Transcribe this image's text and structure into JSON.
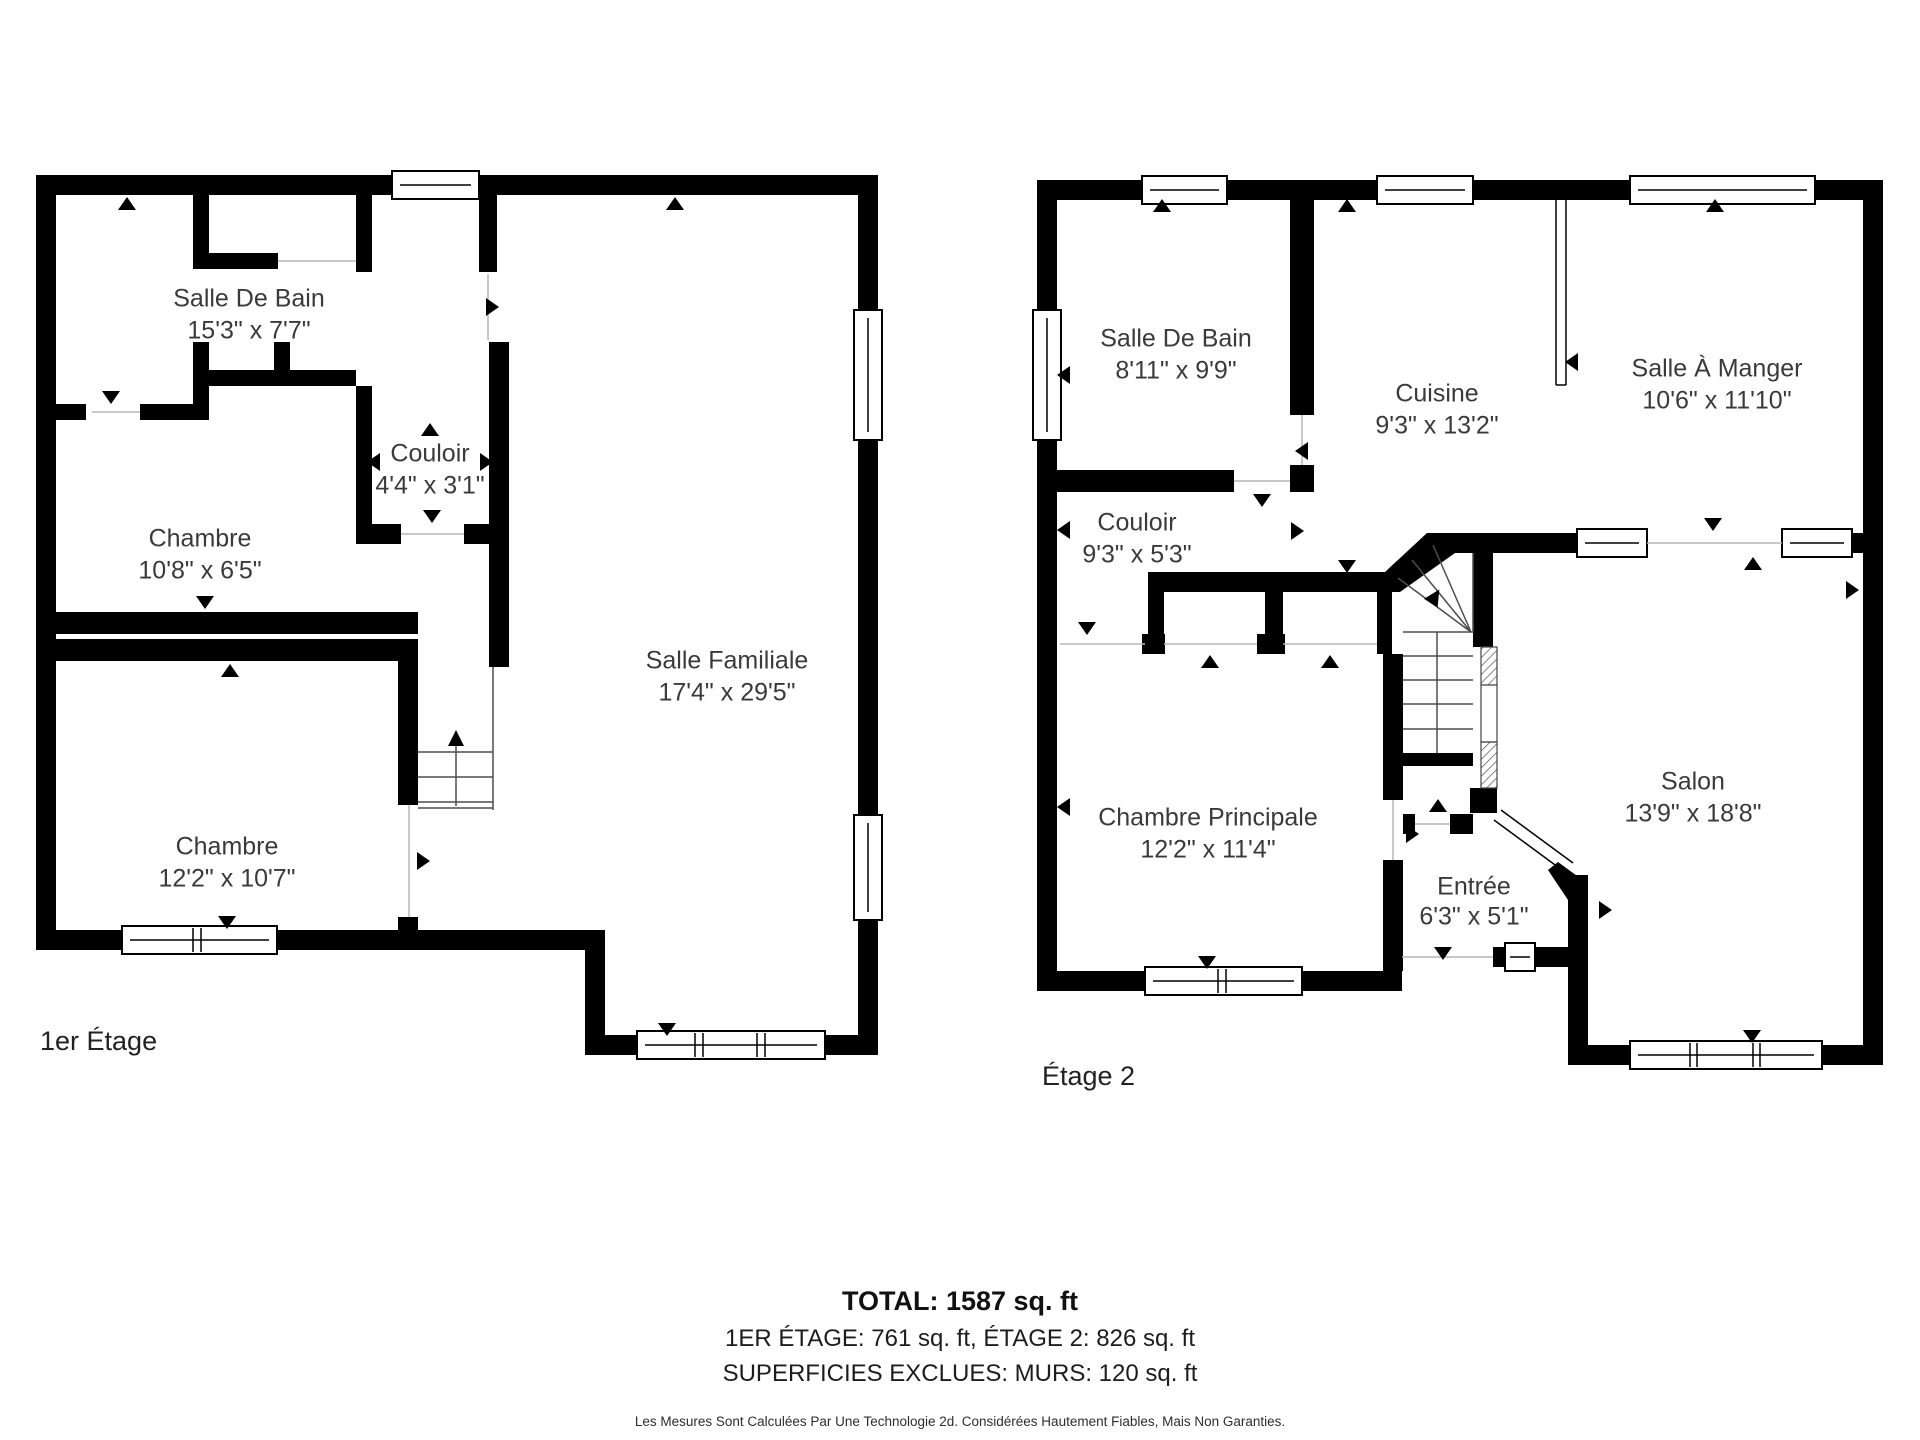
{
  "floors": [
    {
      "label": "1er Étage",
      "rooms": [
        {
          "name": "Salle De Bain",
          "dims": "15'3\" x 7'7\""
        },
        {
          "name": "Couloir",
          "dims": "4'4\" x 3'1\""
        },
        {
          "name": "Chambre",
          "dims": "10'8\" x 6'5\""
        },
        {
          "name": "Chambre",
          "dims": "12'2\" x 10'7\""
        },
        {
          "name": "Salle Familiale",
          "dims": "17'4\" x 29'5\""
        }
      ]
    },
    {
      "label": "Étage 2",
      "rooms": [
        {
          "name": "Salle De Bain",
          "dims": "8'11\" x 9'9\""
        },
        {
          "name": "Cuisine",
          "dims": "9'3\" x 13'2\""
        },
        {
          "name": "Salle À Manger",
          "dims": "10'6\" x 11'10\""
        },
        {
          "name": "Couloir",
          "dims": "9'3\" x 5'3\""
        },
        {
          "name": "Chambre Principale",
          "dims": "12'2\" x 11'4\""
        },
        {
          "name": "Entrée",
          "dims": "6'3\" x 5'1\""
        },
        {
          "name": "Salon",
          "dims": "13'9\" x 18'8\""
        }
      ]
    }
  ],
  "summary": {
    "total": "TOTAL: 1587 sq. ft",
    "floors_line": "1ER ÉTAGE: 761 sq. ft, ÉTAGE 2: 826 sq. ft",
    "excluded": "SUPERFICIES EXCLUES: MURS: 120 sq. ft",
    "disclaimer": "Les Mesures Sont Calculées Par Une Technologie 2d. Considérées Hautement Fiables, Mais Non Garanties."
  },
  "colors": {
    "wall": "#000000",
    "room_text": "#3a3a3a",
    "background": "#ffffff"
  }
}
